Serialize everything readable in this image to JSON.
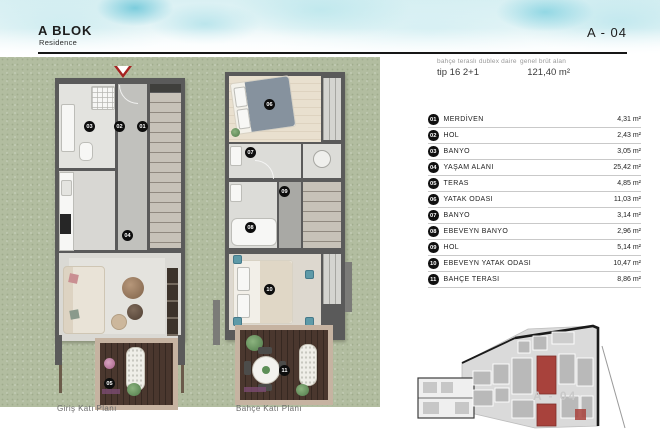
{
  "header": {
    "block_title": "A BLOK",
    "block_subtitle": "Residence",
    "unit_code": "A - 04"
  },
  "info": {
    "type_label": "bahçe teraslı dublex daire",
    "type_value": "tip 16 2+1",
    "area_label": "genel brüt alan",
    "area_value": "121,40 m²"
  },
  "rooms": [
    {
      "no": "01",
      "name": "MERDİVEN",
      "area": "4,31 m²"
    },
    {
      "no": "02",
      "name": "HOL",
      "area": "2,43 m²"
    },
    {
      "no": "03",
      "name": "BANYO",
      "area": "3,05 m²"
    },
    {
      "no": "04",
      "name": "YAŞAM ALANI",
      "area": "25,42 m²"
    },
    {
      "no": "05",
      "name": "TERAS",
      "area": "4,85 m²"
    },
    {
      "no": "06",
      "name": "YATAK ODASI",
      "area": "11,03 m²"
    },
    {
      "no": "07",
      "name": "BANYO",
      "area": "3,14 m²"
    },
    {
      "no": "08",
      "name": "EBEVEYN BANYO",
      "area": "2,96 m²"
    },
    {
      "no": "09",
      "name": "HOL",
      "area": "5,14 m²"
    },
    {
      "no": "10",
      "name": "EBEVEYN YATAK ODASI",
      "area": "10,47 m²"
    },
    {
      "no": "11",
      "name": "BAHÇE TERASI",
      "area": "8,86 m²"
    }
  ],
  "plans": [
    {
      "caption": "Giriş Katı Planı",
      "markers": [
        "01",
        "02",
        "03",
        "04",
        "05"
      ]
    },
    {
      "caption": "Bahçe Katı Planı",
      "markers": [
        "06",
        "07",
        "08",
        "09",
        "10",
        "11"
      ]
    }
  ],
  "keyplan": {
    "label": "A - 04",
    "highlight_color": "#a8423c"
  },
  "colors": {
    "highlight_red": "#a8423c",
    "wall_gray": "#5a5a5a",
    "grass_green": "#b2bda0",
    "deck_wood": "#4a372e",
    "deck_frame": "#c6b3a1",
    "watercolor_teal": "#7fd0de"
  }
}
